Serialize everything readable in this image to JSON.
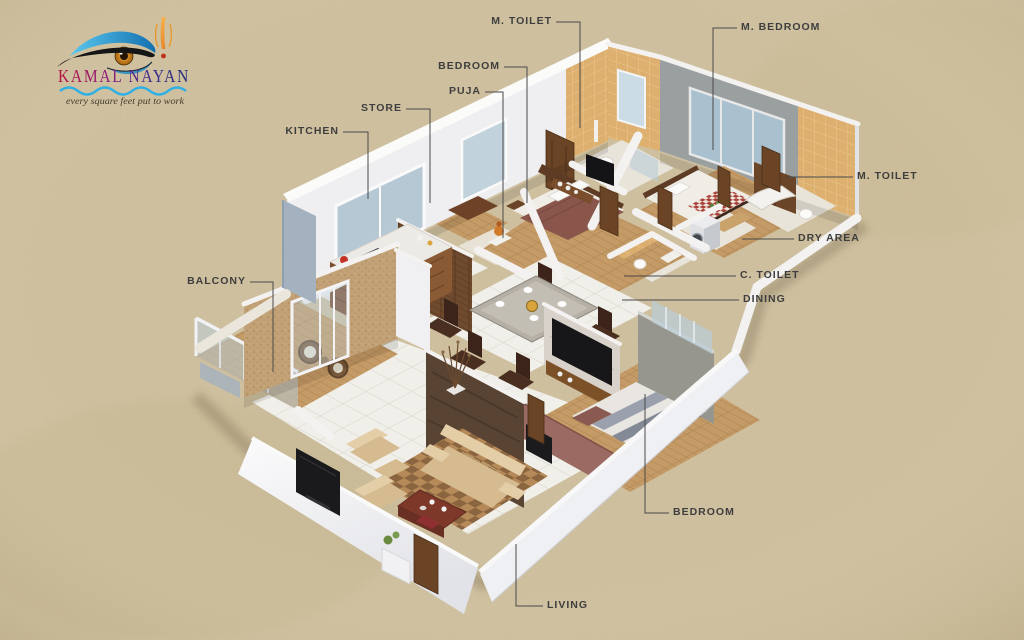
{
  "logo": {
    "brand": "KAMAL NAYAN",
    "tagline": "every square feet put to work",
    "brand_gradient": [
      "#b5123f",
      "#8e1f7e",
      "#3a2d8e",
      "#252f7a"
    ],
    "wave_color": "#2fb0e4",
    "eye": {
      "shadow": "#2d9fd6",
      "iris": "#dd9022",
      "tilak": "#f0a13c",
      "dot": "#c2301c"
    }
  },
  "floorplan": {
    "type": "3d-isometric-apartment-floorplan",
    "labels": [
      {
        "id": "m-toilet-top",
        "text": "M. TOILET"
      },
      {
        "id": "m-bedroom",
        "text": "M. BEDROOM"
      },
      {
        "id": "bedroom-top",
        "text": "BEDROOM"
      },
      {
        "id": "puja",
        "text": "PUJA"
      },
      {
        "id": "store",
        "text": "STORE"
      },
      {
        "id": "kitchen",
        "text": "KITCHEN"
      },
      {
        "id": "balcony",
        "text": "BALCONY"
      },
      {
        "id": "m-toilet-right",
        "text": "M. TOILET"
      },
      {
        "id": "dry-area",
        "text": "DRY AREA"
      },
      {
        "id": "c-toilet",
        "text": "C. TOILET"
      },
      {
        "id": "dining",
        "text": "DINING"
      },
      {
        "id": "bedroom-bottom",
        "text": "BEDROOM"
      },
      {
        "id": "living",
        "text": "LIVING"
      }
    ]
  },
  "colors": {
    "paper": "#d2c3a2",
    "wall_white": "#f3f2f1",
    "wall_shade": "#c9cdd5",
    "slate": "#a4b2c0",
    "sand_wall": "#c2a176",
    "tile_mustard": "#ddb070",
    "wood": "#c49a66",
    "floor_tile": "#f0efe9",
    "sofa_beige": "#d6bb90",
    "rug_checker": "#b68a58",
    "bed_maroon": "#8a564c",
    "accent_gray": "#9aa09f",
    "glass": "#b9cdd9",
    "label_text": "#3e3e3e",
    "leader_line": "#4a4a4a"
  }
}
